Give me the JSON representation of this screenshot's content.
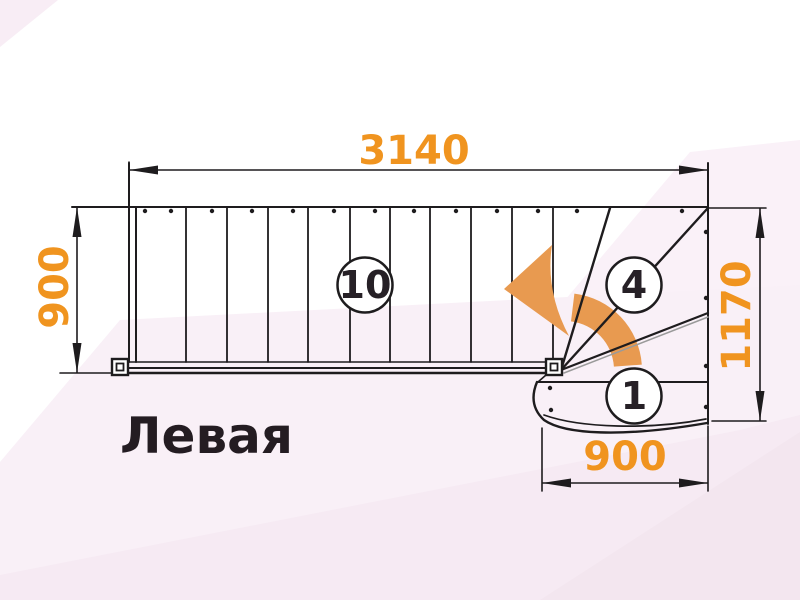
{
  "diagram": {
    "title_label": "Левая",
    "type": "stair-plan-top-view"
  },
  "dimensions": {
    "top_length": "3140",
    "flight_width": "900",
    "right_height": "1170",
    "bottom_width": "900"
  },
  "step_markers": {
    "straight_flight": "10",
    "winder_steps": "4",
    "first_step": "1"
  },
  "colors": {
    "dimension_text": "#f0941f",
    "arrow_fill": "#e89a50",
    "line": "#1e1c1e",
    "edge_highlight": "#9a9a9a",
    "title_text": "#241c22",
    "background": "#ffffff",
    "facet_pink_light": "#f9f0f7",
    "facet_pink_mid": "#f6eaf3",
    "facet_pink_dark": "#f3e6ef",
    "facet_pink_corner": "#f8edf5"
  }
}
